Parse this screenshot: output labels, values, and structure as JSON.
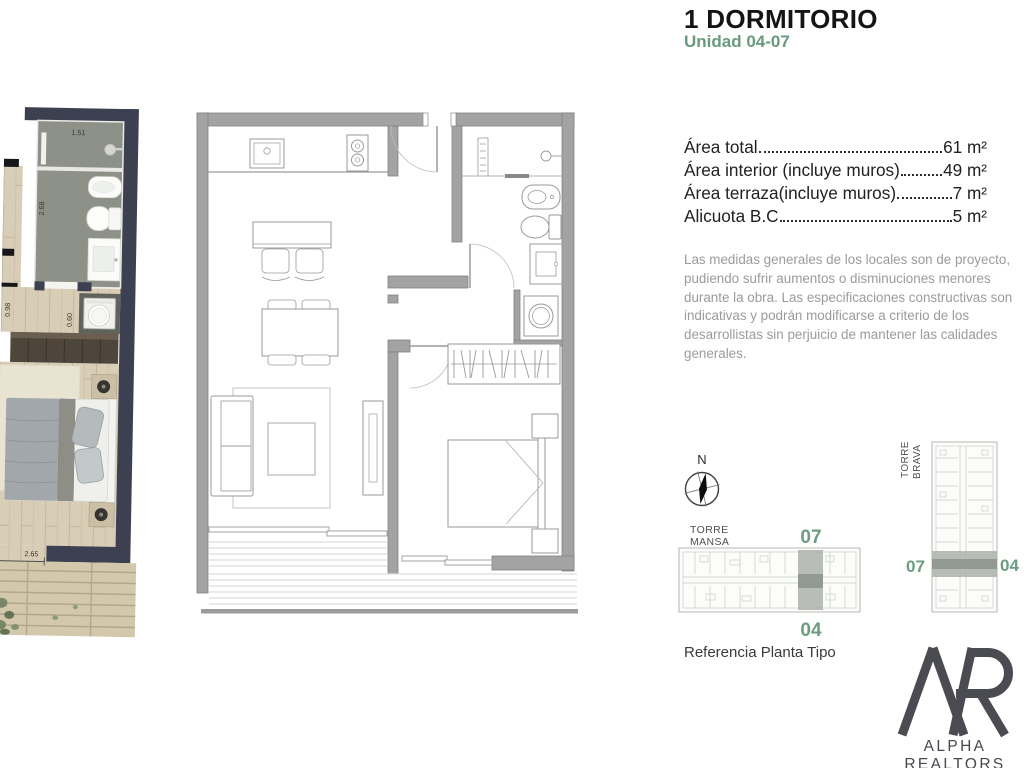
{
  "header": {
    "title": "1 DORMITORIO",
    "subtitle": "Unidad 04-07"
  },
  "areas": [
    {
      "label": "Área total",
      "value": "61 m²"
    },
    {
      "label": "Área interior (incluye muros)",
      "value": "49 m²"
    },
    {
      "label": "Área terraza(incluye muros)",
      "value": "7 m²"
    },
    {
      "label": "Alicuota B.C",
      "value": "5 m²"
    }
  ],
  "disclaimer": "Las medidas generales de los locales son de proyecto, pudiendo sufrir aumentos o disminuciones menores durante la obra. Las especificaciones constructivas son indicativas y podrán modificarse a criterio de los desarrollistas sin perjuicio de mantener las calidades generales.",
  "compass": {
    "label": "N"
  },
  "reference": {
    "caption": "Referencia Planta Tipo",
    "torre_mansa": {
      "name_line1": "TORRE",
      "name_line2": "MANSA",
      "unit_top": "07",
      "unit_bottom": "04"
    },
    "torre_brava": {
      "name_line1": "TORRE",
      "name_line2": "BRAVA",
      "unit_left": "07",
      "unit_right": "04"
    }
  },
  "floorplan": {
    "dims": {
      "shower_width": "1.51",
      "bath_length": "2.68",
      "hall_width": "0.98",
      "laundry_width": "0.60",
      "bed_width": "2.65"
    }
  },
  "logo": {
    "name": "ALPHA REALTORS",
    "tagline": "INMOBILIARIA"
  },
  "colors": {
    "accent_green": "#689a7e",
    "wall_dark": "#3c4050",
    "plan_gray": "#a3a3a3"
  }
}
